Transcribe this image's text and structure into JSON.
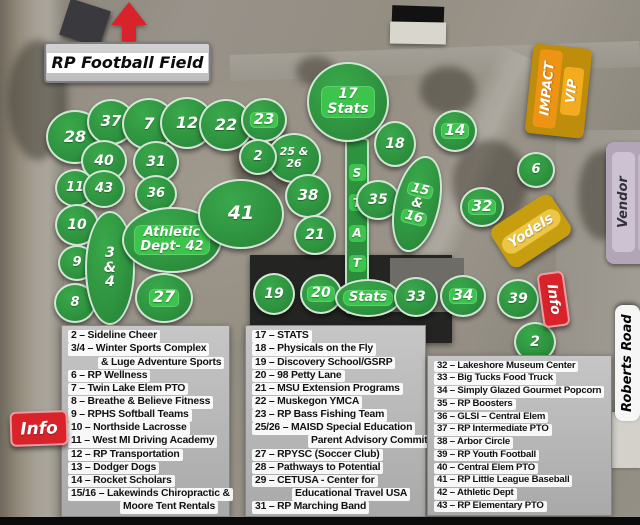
{
  "signs": {
    "football_field": "RP Football Field",
    "impact": "IMPACT",
    "vip": "VIP",
    "vendor": "Vendor",
    "roberts_road": "Roberts Road",
    "yodels": "Yodels",
    "info_left": "Info",
    "info_right": "Info"
  },
  "colors": {
    "booth_green": "#2f9440",
    "chip_green": "#3cc44d",
    "red": "#d8232a",
    "impact_gold": "#bd8d0b",
    "impact_orange": "#ee9414",
    "vip_amber": "#f3ac1e",
    "yodels_gold": "#c89e11",
    "yodels_chip": "#ecc644",
    "vendor_purple": "#b2a5b8",
    "road_sign_white": "#f6f6f6",
    "legend_gray": "#b5b5b5"
  },
  "stats_strip": {
    "letters": [
      "S",
      "T",
      "A",
      "T",
      "S"
    ]
  },
  "booths": [
    {
      "id": "28",
      "x": 75,
      "y": 137,
      "w": 58,
      "h": 54,
      "fs": 16
    },
    {
      "id": "37",
      "x": 111,
      "y": 122,
      "w": 48,
      "h": 46,
      "fs": 15
    },
    {
      "id": "7",
      "x": 149,
      "y": 124,
      "w": 54,
      "h": 52,
      "fs": 16
    },
    {
      "id": "12",
      "x": 187,
      "y": 123,
      "w": 54,
      "h": 52,
      "fs": 16
    },
    {
      "id": "22",
      "x": 226,
      "y": 125,
      "w": 54,
      "h": 52,
      "fs": 16
    },
    {
      "id": "23",
      "x": 264,
      "y": 120,
      "w": 46,
      "h": 44,
      "fs": 15,
      "bright": true
    },
    {
      "id": "40",
      "x": 104,
      "y": 161,
      "w": 46,
      "h": 42,
      "fs": 14
    },
    {
      "id": "31",
      "x": 156,
      "y": 162,
      "w": 46,
      "h": 42,
      "fs": 14
    },
    {
      "id": "25/26",
      "lines": [
        "25 &",
        "26"
      ],
      "x": 294,
      "y": 158,
      "w": 54,
      "h": 50,
      "fs": 11
    },
    {
      "id": "2",
      "x": 258,
      "y": 157,
      "w": 38,
      "h": 36,
      "fs": 13
    },
    {
      "id": "11",
      "x": 75,
      "y": 188,
      "w": 40,
      "h": 38,
      "fs": 13
    },
    {
      "id": "43",
      "x": 104,
      "y": 189,
      "w": 42,
      "h": 38,
      "fs": 13
    },
    {
      "id": "36",
      "x": 156,
      "y": 194,
      "w": 42,
      "h": 38,
      "fs": 13
    },
    {
      "id": "10",
      "x": 77,
      "y": 225,
      "w": 44,
      "h": 42,
      "fs": 14
    },
    {
      "id": "9",
      "x": 77,
      "y": 263,
      "w": 38,
      "h": 36,
      "fs": 13
    },
    {
      "id": "8",
      "x": 75,
      "y": 303,
      "w": 42,
      "h": 40,
      "fs": 13
    },
    {
      "id": "3/4",
      "lines": [
        "3",
        "&",
        "4"
      ],
      "x": 110,
      "y": 268,
      "w": 50,
      "h": 114,
      "fs": 14
    },
    {
      "id": "42",
      "lines": [
        "Athletic",
        "Dept- 42"
      ],
      "x": 172,
      "y": 240,
      "w": 100,
      "h": 66,
      "fs": 13,
      "chipBlock": true
    },
    {
      "id": "41",
      "x": 241,
      "y": 214,
      "w": 86,
      "h": 70,
      "fs": 19
    },
    {
      "id": "38",
      "x": 308,
      "y": 196,
      "w": 46,
      "h": 44,
      "fs": 15
    },
    {
      "id": "21",
      "x": 315,
      "y": 235,
      "w": 42,
      "h": 40,
      "fs": 14
    },
    {
      "id": "27",
      "x": 164,
      "y": 298,
      "w": 58,
      "h": 50,
      "fs": 16,
      "bright": true
    },
    {
      "id": "19",
      "x": 274,
      "y": 294,
      "w": 42,
      "h": 42,
      "fs": 14
    },
    {
      "id": "20",
      "x": 321,
      "y": 294,
      "w": 42,
      "h": 40,
      "fs": 14,
      "bright": true
    },
    {
      "id": "17",
      "lines": [
        "17",
        "Stats"
      ],
      "x": 348,
      "y": 102,
      "w": 82,
      "h": 80,
      "fs": 14,
      "chipBlock": true
    },
    {
      "id": "18",
      "x": 395,
      "y": 144,
      "w": 42,
      "h": 46,
      "fs": 14
    },
    {
      "id": "35",
      "x": 378,
      "y": 200,
      "w": 44,
      "h": 40,
      "fs": 14
    },
    {
      "id": "15/16",
      "lines": [
        "15",
        "&",
        "16"
      ],
      "x": 417,
      "y": 204,
      "w": 46,
      "h": 98,
      "fs": 13,
      "rot": 13,
      "brightLines": [
        0,
        2
      ]
    },
    {
      "id": "14",
      "x": 455,
      "y": 131,
      "w": 44,
      "h": 42,
      "fs": 15,
      "bright": true
    },
    {
      "id": "32",
      "x": 482,
      "y": 207,
      "w": 44,
      "h": 40,
      "fs": 15,
      "bright": true
    },
    {
      "id": "6",
      "x": 536,
      "y": 170,
      "w": 38,
      "h": 36,
      "fs": 13
    },
    {
      "id": "stats-south",
      "lines": [
        "Stats"
      ],
      "x": 368,
      "y": 298,
      "w": 66,
      "h": 38,
      "fs": 13,
      "chipBlock": true
    },
    {
      "id": "33",
      "x": 416,
      "y": 297,
      "w": 44,
      "h": 40,
      "fs": 14
    },
    {
      "id": "34",
      "x": 463,
      "y": 296,
      "w": 46,
      "h": 42,
      "fs": 15,
      "bright": true
    },
    {
      "id": "39",
      "x": 518,
      "y": 299,
      "w": 42,
      "h": 40,
      "fs": 14
    },
    {
      "id": "2b",
      "label": "2",
      "x": 535,
      "y": 342,
      "w": 42,
      "h": 40,
      "fs": 14
    }
  ],
  "legend": {
    "columns": [
      {
        "x": 61,
        "y": 325,
        "w": 169,
        "h": 192,
        "fs": 10.4,
        "entries": [
          {
            "t": "2 – Sideline Cheer"
          },
          {
            "t": "3/4 – Winter Sports Complex"
          },
          {
            "t": "& Luge Adventure Sports",
            "indent": 30
          },
          {
            "t": "6 – RP Wellness"
          },
          {
            "t": "7 – Twin Lake Elem PTO"
          },
          {
            "t": "8 – Breathe & Believe Fitness"
          },
          {
            "t": "9 – RPHS Softball Teams"
          },
          {
            "t": "10 – Northside Lacrosse"
          },
          {
            "t": "11 – West MI Driving Academy"
          },
          {
            "t": "12 – RP Transportation"
          },
          {
            "t": "13 – Dodger Dogs"
          },
          {
            "t": "14 – Rocket Scholars"
          },
          {
            "t": "15/16 – Lakewinds Chiropractic &"
          },
          {
            "t": "Moore Tent Rentals",
            "indent": 52
          }
        ]
      },
      {
        "x": 245,
        "y": 325,
        "w": 181,
        "h": 192,
        "fs": 10.4,
        "entries": [
          {
            "t": "17 – STATS"
          },
          {
            "t": "18 – Physicals on the Fly"
          },
          {
            "t": "19 – Discovery School/GSRP"
          },
          {
            "t": "20 – 98 Petty Lane"
          },
          {
            "t": "21 – MSU Extension Programs"
          },
          {
            "t": "22 – Muskegon YMCA"
          },
          {
            "t": "23 – RP Bass Fishing Team"
          },
          {
            "t": "25/26 – MAISD Special Education"
          },
          {
            "t": "Parent Advisory Committee",
            "indent": 56
          },
          {
            "t": "27 – RPYSC (Soccer Club)"
          },
          {
            "t": "28 – Pathways to Potential"
          },
          {
            "t": "29 – CETUSA - Center for"
          },
          {
            "t": "Educational Travel USA",
            "indent": 40
          },
          {
            "t": "31 – RP Marching Band"
          }
        ]
      },
      {
        "x": 427,
        "y": 355,
        "w": 185,
        "h": 161,
        "fs": 9.6,
        "entries": [
          {
            "t": "32 – Lakeshore Museum Center"
          },
          {
            "t": "33 – Big Tucks Food Truck"
          },
          {
            "t": "34 – Simply Glazed Gourmet Popcorn"
          },
          {
            "t": "35 – RP Boosters"
          },
          {
            "t": "36 – GLSI – Central Elem"
          },
          {
            "t": "37 – RP Intermediate PTO"
          },
          {
            "t": "38 – Arbor Circle"
          },
          {
            "t": "39 – RP Youth Football"
          },
          {
            "t": "40 – Central Elem PTO"
          },
          {
            "t": "41 – RP Little League Baseball"
          },
          {
            "t": "42 – Athletic Dept"
          },
          {
            "t": "43 – RP Elementary PTO"
          }
        ]
      }
    ]
  }
}
